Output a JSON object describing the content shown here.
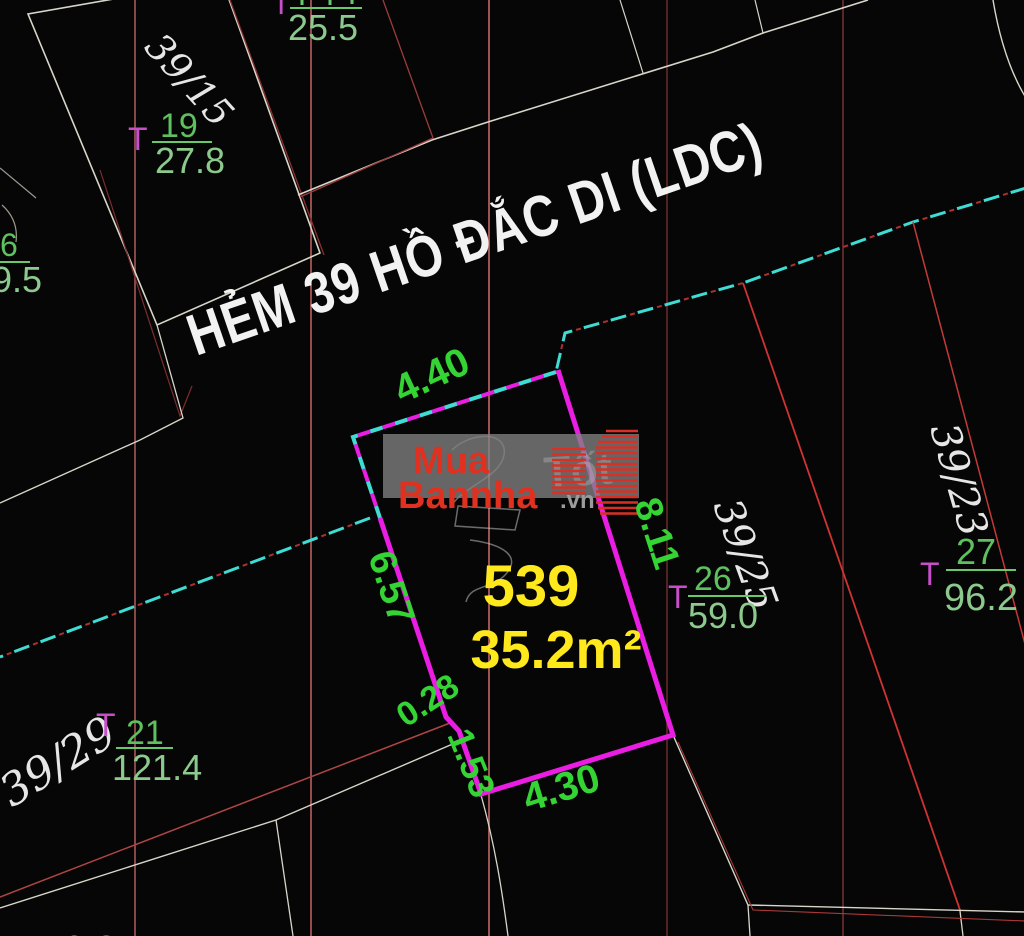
{
  "street": {
    "label": "HẺM 39 HỒ ĐẮC DI (LDC)"
  },
  "plot": {
    "number": "539",
    "area_label": "35.2m²",
    "dimensions": {
      "top": "4.40",
      "left": "6.57",
      "right": "8.11",
      "jog": "0.28",
      "step": "1.53",
      "bottom": "4.30"
    }
  },
  "parcels": [
    {
      "label": "39/15",
      "marker": "T",
      "numerator": "19",
      "denominator": "27.8"
    },
    {
      "label": "",
      "marker": "T",
      "numerator": "",
      "denominator": "25.5"
    },
    {
      "label": "",
      "marker": "",
      "numerator": "6",
      "denominator": "9.5"
    },
    {
      "label": "39/25",
      "marker": "T",
      "numerator": "26",
      "denominator": "59.0"
    },
    {
      "label": "39/23",
      "marker": "T",
      "numerator": "27",
      "denominator": "96.2"
    },
    {
      "label": "39/29",
      "marker": "T",
      "numerator": "21",
      "denominator": "121.4"
    },
    {
      "label": "",
      "marker": "",
      "numerator": "",
      "denominator": "9.3"
    }
  ],
  "watermark": {
    "line1": "Mua",
    "line2": "Bannha",
    "suffix": ".vn",
    "ghost": "Tốt"
  },
  "colors": {
    "boundary_magenta": "#ea1de2",
    "dash_cyan": "#3edcd2",
    "dash_red": "#b03030",
    "dim_green": "#35d435",
    "fraction_green": "#8cc98c",
    "numerator_green": "#5ec05e",
    "marker_magenta": "#c74fc7",
    "plot_yellow": "#ffe81c",
    "parcel_red": "#cf3333",
    "grid_maroon": "#a85858",
    "white_line": "#d8d5c9",
    "watermark_red": "#e03020",
    "street_white": "#f2f2f2"
  }
}
